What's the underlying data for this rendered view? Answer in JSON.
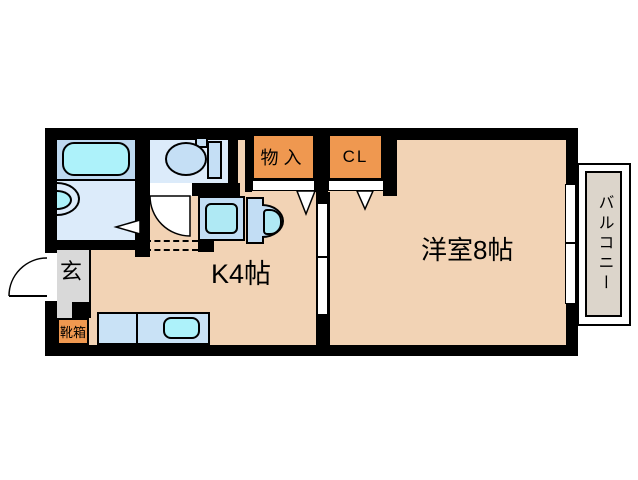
{
  "floor_plan": {
    "labels": {
      "entrance": "玄",
      "shoe_box": "靴箱",
      "kitchen": "K4帖",
      "western_room": "洋室8帖",
      "storage": "物入",
      "closet": "CL",
      "balcony": "バルコニー"
    },
    "fixtures": [
      "bathtub",
      "bath-sink",
      "toilet",
      "washing-machine-pan",
      "washbasin",
      "kitchen-counter",
      "kitchen-sink"
    ],
    "colors": {
      "wall": "#000000",
      "room_floor": "#f2d3b5",
      "closet_fill": "#ef9850",
      "bathroom_upper": "#bed9f0",
      "bathroom_lower": "#dcebfa",
      "water_cyan": "#adf2fa",
      "fixture_blue": "#c5dff5",
      "counter_blue": "#c9e2f6",
      "entrance_gray": "#d9d9d9",
      "balcony_gray": "#dcd5cb"
    }
  }
}
